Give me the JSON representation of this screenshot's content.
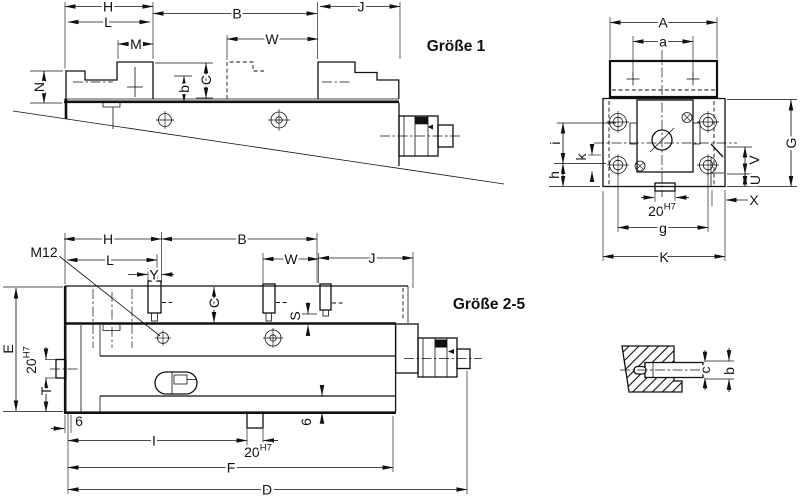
{
  "drawing": {
    "background": "#ffffff",
    "line_color": "#111111",
    "labels": [
      {
        "id": "tv-H",
        "t": "H",
        "x": 108,
        "y": 6.5
      },
      {
        "id": "tv-L",
        "t": "L",
        "x": 108,
        "y": 22
      },
      {
        "id": "tv-M",
        "t": "M",
        "x": 136,
        "y": 44
      },
      {
        "id": "tv-B",
        "t": "B",
        "x": 237,
        "y": 13.5
      },
      {
        "id": "tv-W",
        "t": "W",
        "x": 272,
        "y": 39
      },
      {
        "id": "tv-J",
        "t": "J",
        "x": 361,
        "y": 6.5
      },
      {
        "id": "tv-N",
        "t": "N",
        "x": 39,
        "y": 87,
        "r": -90
      },
      {
        "id": "tv-C",
        "t": "C",
        "x": 206,
        "y": 80,
        "r": -90
      },
      {
        "id": "tv-b",
        "t": "b",
        "x": 184,
        "y": 89,
        "r": -90
      },
      {
        "id": "size1",
        "t": "Größe 1",
        "x": 456,
        "y": 46,
        "cls": "title"
      },
      {
        "id": "ev-A",
        "t": "A",
        "x": 663,
        "y": 22.5
      },
      {
        "id": "ev-a",
        "t": "a",
        "x": 663,
        "y": 41.5
      },
      {
        "id": "ev-i",
        "t": "i",
        "x": 555,
        "y": 143,
        "r": -90
      },
      {
        "id": "ev-k",
        "t": "k",
        "x": 581,
        "y": 157,
        "r": -90
      },
      {
        "id": "ev-h",
        "t": "h",
        "x": 554,
        "y": 175,
        "r": -90
      },
      {
        "id": "ev-G",
        "t": "G",
        "x": 791,
        "y": 143,
        "r": -90
      },
      {
        "id": "ev-V",
        "t": "V",
        "x": 754,
        "y": 160,
        "r": -90
      },
      {
        "id": "ev-U",
        "t": "U",
        "x": 755,
        "y": 180,
        "r": -90
      },
      {
        "id": "ev-X",
        "t": "X",
        "x": 754,
        "y": 200
      },
      {
        "id": "ev-20h7",
        "t": "20",
        "s": "H7",
        "x": 662,
        "y": 211
      },
      {
        "id": "ev-g",
        "t": "g",
        "x": 663,
        "y": 228
      },
      {
        "id": "ev-K",
        "t": "K",
        "x": 664,
        "y": 257
      },
      {
        "id": "bv-M12",
        "t": "M12",
        "x": 44,
        "y": 252
      },
      {
        "id": "bv-H",
        "t": "H",
        "x": 108,
        "y": 239
      },
      {
        "id": "bv-B",
        "t": "B",
        "x": 242,
        "y": 239
      },
      {
        "id": "bv-L",
        "t": "L",
        "x": 110,
        "y": 260
      },
      {
        "id": "bv-W",
        "t": "W",
        "x": 291,
        "y": 259
      },
      {
        "id": "bv-J",
        "t": "J",
        "x": 372,
        "y": 258
      },
      {
        "id": "bv-Y",
        "t": "Y",
        "x": 154,
        "y": 274.5
      },
      {
        "id": "bv-C",
        "t": "C",
        "x": 214,
        "y": 303,
        "r": -90
      },
      {
        "id": "bv-S",
        "t": "S",
        "x": 295,
        "y": 316,
        "r": -90
      },
      {
        "id": "bv-E",
        "t": "E",
        "x": 8,
        "y": 349,
        "r": -90
      },
      {
        "id": "bv-20h7-rot",
        "t": "20",
        "s": "H7",
        "x": 31,
        "y": 360,
        "r": -90
      },
      {
        "id": "bv-T",
        "t": "T",
        "x": 46,
        "y": 391,
        "r": -90
      },
      {
        "id": "bv-6-left",
        "t": "6",
        "x": 79,
        "y": 421
      },
      {
        "id": "bv-I",
        "t": "I",
        "x": 154,
        "y": 440.5
      },
      {
        "id": "bv-20h7-slot",
        "t": "20",
        "s": "H7",
        "x": 258,
        "y": 452
      },
      {
        "id": "bv-F",
        "t": "F",
        "x": 231,
        "y": 467.5
      },
      {
        "id": "bv-D",
        "t": "D",
        "x": 267,
        "y": 489.5
      },
      {
        "id": "bv-6-right",
        "t": "6",
        "x": 306,
        "y": 422,
        "r": -90
      },
      {
        "id": "size25",
        "t": "Größe 2-5",
        "x": 489,
        "y": 304,
        "cls": "title"
      },
      {
        "id": "dt-c",
        "t": "c",
        "x": 705,
        "y": 370,
        "r": -90
      },
      {
        "id": "dt-b",
        "t": "b",
        "x": 729,
        "y": 371,
        "r": -90
      }
    ]
  }
}
